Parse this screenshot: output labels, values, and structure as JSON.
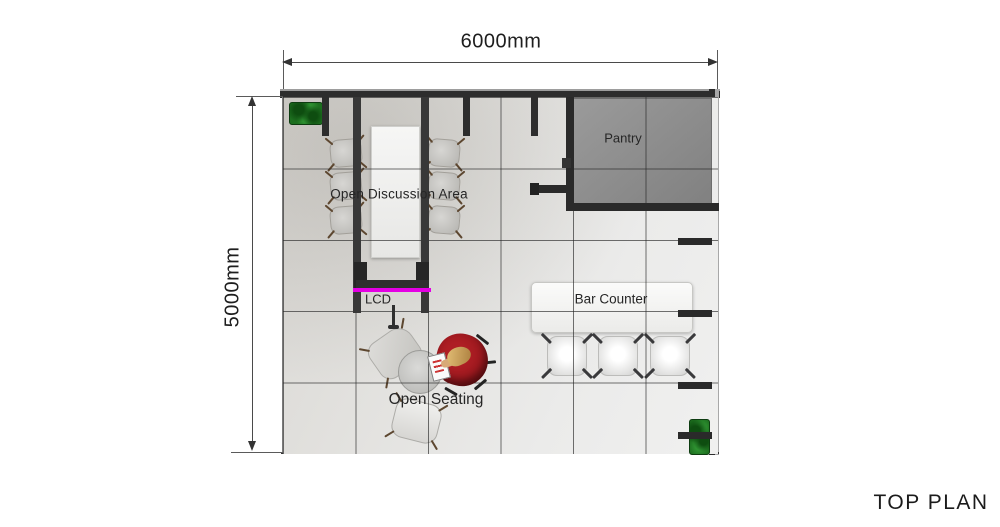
{
  "title": "TOP PLAN",
  "dimensions": {
    "width_label": "6000mm",
    "height_label": "5000mm"
  },
  "areas": {
    "pantry": "Pantry",
    "open_discussion": "Open Discussion Area",
    "lcd": "LCD",
    "bar_counter": "Bar Counter",
    "open_seating": "Open Seating"
  },
  "furniture_counts": {
    "discussion_chairs": 6,
    "bar_stools": 3,
    "lounge_chairs": 2,
    "round_tables": 1,
    "plants": 2,
    "occupants": 1
  },
  "colors": {
    "lcd_accent": "#E400E4",
    "plant_green": "#1D6F1F",
    "wall_dark": "#2D2D2D",
    "pantry_fill": "#8F8F8F",
    "armchair_red": "#AE1E24"
  }
}
